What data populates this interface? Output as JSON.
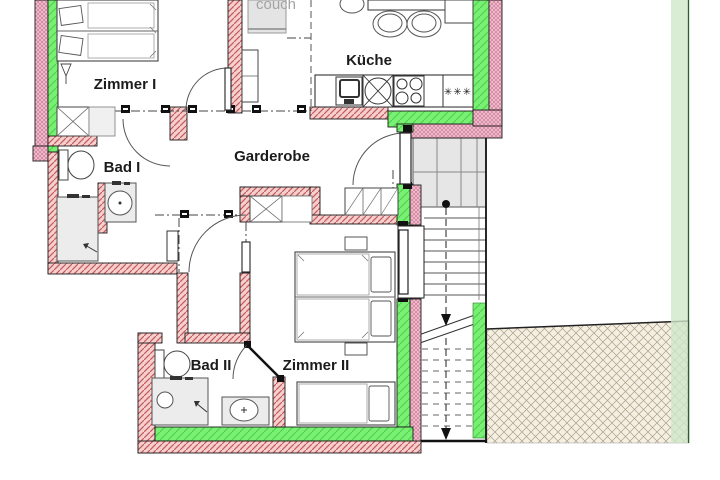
{
  "floorplan": {
    "rooms": {
      "zimmer1": "Zimmer I",
      "kueche": "Küche",
      "bad1": "Bad I",
      "garderobe": "Garderobe",
      "bad2": "Bad II",
      "zimmer2": "Zimmer II"
    },
    "annotations": {
      "couch_label": "couch",
      "freezer_stars": "✳✳✳"
    },
    "colors": {
      "wall_masonry_pink": "#f6cecd",
      "wall_hatch_line": "#c15b5b",
      "wall_checker_pink": "#f5c6d2",
      "insulation_green": "#79ef74",
      "boundary_light_green": "#cfe7c9",
      "ground_hatch_beige": "#f4efe2",
      "furniture_gray": "#ececec",
      "stair_landing_gray": "#e6e6e6",
      "label_black": "#1c1c1c",
      "couch_gray": "#a3a3a3"
    }
  }
}
